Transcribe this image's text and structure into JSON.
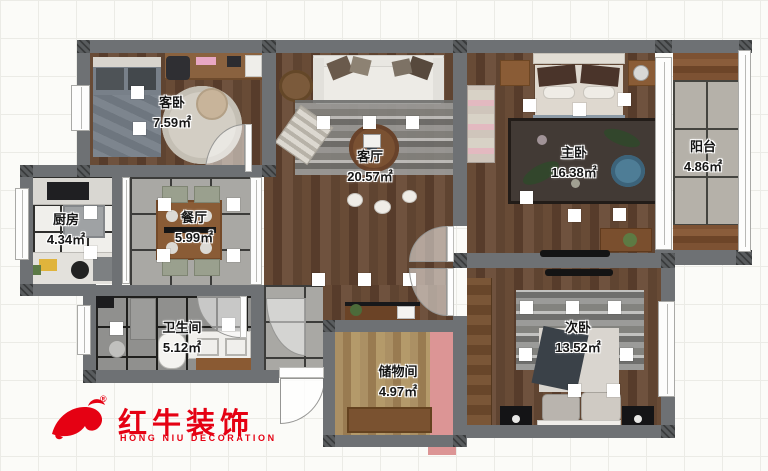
{
  "logo": {
    "brand_cn": "红牛装饰",
    "brand_en": "HONG NIU DECORATION",
    "registered": "®",
    "color": "#e50113"
  },
  "rooms": {
    "guest_bedroom": {
      "name": "客卧",
      "area": "7.59㎡"
    },
    "living_room": {
      "name": "客厅",
      "area": "20.57㎡"
    },
    "master_bedroom": {
      "name": "主卧",
      "area": "16.38㎡"
    },
    "balcony": {
      "name": "阳台",
      "area": "4.86㎡"
    },
    "kitchen": {
      "name": "厨房",
      "area": "4.34㎡"
    },
    "dining_room": {
      "name": "餐厅",
      "area": "5.99㎡"
    },
    "bathroom": {
      "name": "卫生间",
      "area": "5.12㎡"
    },
    "storage_room": {
      "name": "储物间",
      "area": "4.97㎡"
    },
    "secondary_bedroom": {
      "name": "次卧",
      "area": "13.52㎡"
    }
  },
  "palette": {
    "wall": "#6e7174",
    "wood_dark": "#5f4431",
    "wood_light": "#a58a5e",
    "tile_gray": "#a9a8a4",
    "tile_dark": "#90908e",
    "tile_white": "#f0efeb",
    "accent_pink": "#dc9595",
    "logo_red": "#e50113"
  }
}
